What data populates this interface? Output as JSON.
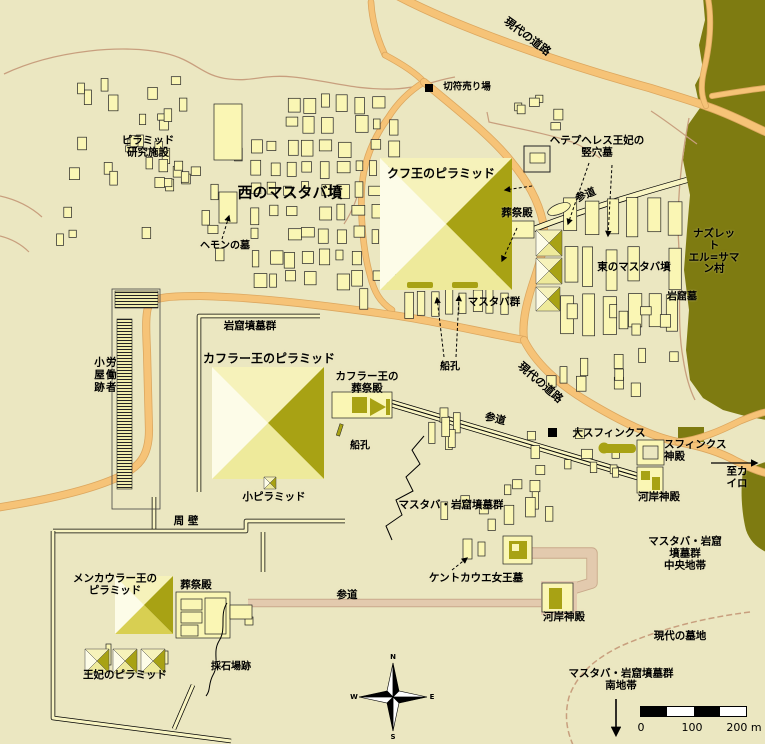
{
  "colors": {
    "background": "#ebe7c1",
    "building": "#faf6b4",
    "building_stroke": "#222222",
    "pyramid_north": "#f6f2ba",
    "pyramid_west": "#fdfce8",
    "pyramid_east": "#a8a214",
    "pyramid_south": "#eeea9b",
    "pyramid_south_dark": "#d8cf52",
    "village": "#7e7b11",
    "road": "#f6c377",
    "road_edge": "#dca75f",
    "trail": "#c89f7e",
    "causeway_pink": "#e3caae",
    "causeway_pink_edge": "#c9a98b",
    "wall": "#f8f4c2",
    "ink": "#000000"
  },
  "compass": {
    "north": "N",
    "east": "E",
    "south": "S",
    "west": "W"
  },
  "scale_bar": {
    "ticks": [
      "0",
      "100",
      "200 m"
    ]
  },
  "labels": [
    {
      "id": "modern-road-top",
      "text": "現代の道路",
      "x": 527,
      "y": 37,
      "size": 11,
      "rot": 37
    },
    {
      "id": "ticket-office",
      "text": "切符売り場",
      "x": 467,
      "y": 88,
      "size": 9.5
    },
    {
      "id": "pyramid-research-facility",
      "text": "ピラミッド\n研究施設",
      "x": 148,
      "y": 147,
      "size": 10.5
    },
    {
      "id": "west-mastaba-tombs",
      "text": "西のマスタバ墳",
      "x": 290,
      "y": 193,
      "size": 15
    },
    {
      "id": "khufu-pyramid",
      "text": "クフ王のピラミッド",
      "x": 441,
      "y": 174,
      "size": 12
    },
    {
      "id": "hetepheres-shaft-tomb",
      "text": "ヘテプヘレス王妃の\n竪穴墓",
      "x": 597,
      "y": 147,
      "size": 10.5
    },
    {
      "id": "khufu-mortuary-temple",
      "text": "葬祭殿",
      "x": 517,
      "y": 214,
      "size": 10.5
    },
    {
      "id": "khufu-causeway",
      "text": "参道",
      "x": 586,
      "y": 196,
      "size": 10.5,
      "rot": -23
    },
    {
      "id": "hemon-tomb",
      "text": "ヘモンの墓",
      "x": 225,
      "y": 246,
      "size": 10
    },
    {
      "id": "east-mastaba-tombs",
      "text": "東のマスタバ墳",
      "x": 634,
      "y": 268,
      "size": 10.5
    },
    {
      "id": "nazlet-village",
      "text": "ナズレット\nエル=サマン村",
      "x": 714,
      "y": 252,
      "size": 10.5
    },
    {
      "id": "rock-cut-tombs-east",
      "text": "岩窟墓",
      "x": 682,
      "y": 297,
      "size": 10
    },
    {
      "id": "mastaba-group",
      "text": "マスタバ群",
      "x": 494,
      "y": 303,
      "size": 10.5
    },
    {
      "id": "rock-cut-tomb-group-nw",
      "text": "岩窟墳墓群",
      "x": 250,
      "y": 327,
      "size": 10.5
    },
    {
      "id": "khafre-pyramid",
      "text": "カフラー王のピラミッド",
      "x": 269,
      "y": 359,
      "size": 12
    },
    {
      "id": "khufu-boat-pits",
      "text": "船孔",
      "x": 450,
      "y": 367,
      "size": 10
    },
    {
      "id": "modern-road-mid",
      "text": "現代の道路",
      "x": 540,
      "y": 383,
      "size": 11,
      "rot": 41
    },
    {
      "id": "khafre-mortuary-temple",
      "text": "カフラー王の\n葬祭殿",
      "x": 367,
      "y": 383,
      "size": 10.5
    },
    {
      "id": "workers-huts",
      "text": "労働者\n小屋跡",
      "x": 104,
      "y": 375,
      "size": 10.5,
      "vertical": true
    },
    {
      "id": "khafre-causeway",
      "text": "参道",
      "x": 495,
      "y": 420,
      "size": 10.5,
      "rot": 14
    },
    {
      "id": "khafre-boat-pits",
      "text": "船孔",
      "x": 360,
      "y": 446,
      "size": 10
    },
    {
      "id": "great-sphinx",
      "text": "大スフィンクス",
      "x": 609,
      "y": 434,
      "size": 10.5
    },
    {
      "id": "sphinx-temple",
      "text": "スフィンクス\n神殿",
      "x": 664,
      "y": 451,
      "size": 10.5,
      "align": "left"
    },
    {
      "id": "to-cairo",
      "text": "至カイロ",
      "x": 737,
      "y": 478,
      "size": 10.5
    },
    {
      "id": "sphinx-valley-temple",
      "text": "河岸神殿",
      "x": 659,
      "y": 498,
      "size": 10.5
    },
    {
      "id": "small-pyramid",
      "text": "小ピラミッド",
      "x": 274,
      "y": 498,
      "size": 10.5
    },
    {
      "id": "mastaba-rock-group-mid",
      "text": "マスタバ・岩窟墳墓群",
      "x": 451,
      "y": 506,
      "size": 10.5
    },
    {
      "id": "enclosure-wall",
      "text": "周 壁",
      "x": 186,
      "y": 522,
      "size": 10.5
    },
    {
      "id": "menkaure-pyramid",
      "text": "メンカウラー王の\nピラミッド",
      "x": 115,
      "y": 585,
      "size": 10.5
    },
    {
      "id": "menkaure-mortuary-temple",
      "text": "葬祭殿",
      "x": 196,
      "y": 586,
      "size": 10.5
    },
    {
      "id": "menkaure-causeway",
      "text": "参道",
      "x": 347,
      "y": 596,
      "size": 10.5
    },
    {
      "id": "khentkaus-tomb",
      "text": "ケントカウエ女王墓",
      "x": 476,
      "y": 579,
      "size": 10.5
    },
    {
      "id": "central-zone",
      "text": "マスタバ・岩窟墳墓群\n中央地帯",
      "x": 685,
      "y": 554,
      "size": 10.5
    },
    {
      "id": "menkaure-valley-temple",
      "text": "河岸神殿",
      "x": 564,
      "y": 618,
      "size": 10.5
    },
    {
      "id": "modern-cemetery",
      "text": "現代の墓地",
      "x": 680,
      "y": 637,
      "size": 10.5
    },
    {
      "id": "quarry-site",
      "text": "採石場跡",
      "x": 231,
      "y": 667,
      "size": 10
    },
    {
      "id": "queens-pyramids",
      "text": "王妃のピラミッド",
      "x": 125,
      "y": 676,
      "size": 10.5
    },
    {
      "id": "south-zone",
      "text": "マスタバ・岩窟墳墓群\n南地帯",
      "x": 621,
      "y": 680,
      "size": 10.5
    }
  ],
  "fields": [
    {
      "name": "west-mastaba-dense",
      "type": "grid",
      "x": 252,
      "y": 96,
      "cols": 9,
      "rows": 9,
      "dx": 17,
      "dy": 22,
      "minW": 6,
      "maxW": 13,
      "minH": 9,
      "maxH": 17,
      "skip": 0.18,
      "seed": 7
    },
    {
      "name": "west-scatter",
      "type": "scatter",
      "x": 55,
      "y": 68,
      "w": 190,
      "h": 200,
      "n": 26,
      "minW": 5,
      "maxW": 11,
      "minH": 7,
      "maxH": 16,
      "seed": 11
    },
    {
      "name": "research-cluster",
      "type": "scatter",
      "x": 125,
      "y": 108,
      "w": 80,
      "h": 85,
      "n": 14,
      "minW": 5,
      "maxW": 10,
      "minH": 6,
      "maxH": 14,
      "seed": 3
    },
    {
      "name": "east-mastaba-slabs",
      "type": "grid",
      "x": 563,
      "y": 200,
      "cols": 6,
      "rows": 3,
      "dx": 21,
      "dy": 48,
      "minW": 10,
      "maxW": 14,
      "minH": 30,
      "maxH": 42,
      "skip": 0.1,
      "seed": 5
    },
    {
      "name": "east-scatter",
      "type": "scatter",
      "x": 540,
      "y": 298,
      "w": 148,
      "h": 100,
      "n": 16,
      "minW": 6,
      "maxW": 11,
      "minH": 8,
      "maxH": 18,
      "seed": 9
    },
    {
      "name": "khufu-south-row",
      "type": "grid",
      "x": 362,
      "y": 291,
      "cols": 11,
      "rows": 1,
      "dx": 14,
      "dy": 0,
      "minW": 7,
      "maxW": 10,
      "minH": 20,
      "maxH": 27,
      "skip": 0.12,
      "seed": 13
    },
    {
      "name": "scatter-mid-west",
      "type": "scatter",
      "x": 415,
      "y": 400,
      "w": 55,
      "h": 62,
      "n": 6,
      "minW": 6,
      "maxW": 9,
      "minH": 12,
      "maxH": 24,
      "seed": 17
    },
    {
      "name": "scatter-mid",
      "type": "scatter",
      "x": 520,
      "y": 425,
      "w": 105,
      "h": 55,
      "n": 10,
      "minW": 6,
      "maxW": 11,
      "minH": 7,
      "maxH": 14,
      "seed": 19
    },
    {
      "name": "scatter-mid-south",
      "type": "scatter",
      "x": 420,
      "y": 468,
      "w": 140,
      "h": 65,
      "n": 11,
      "minW": 6,
      "maxW": 10,
      "minH": 9,
      "maxH": 20,
      "seed": 23
    },
    {
      "name": "north-cluster",
      "type": "scatter",
      "x": 495,
      "y": 95,
      "w": 70,
      "h": 40,
      "n": 6,
      "minW": 6,
      "maxW": 11,
      "minH": 7,
      "maxH": 12,
      "seed": 29
    }
  ]
}
